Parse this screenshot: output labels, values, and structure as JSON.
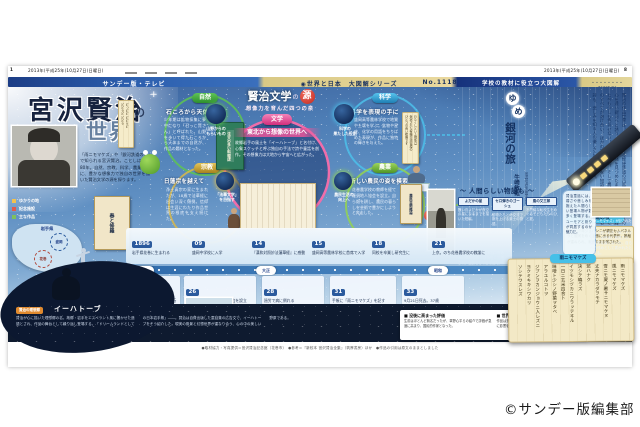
{
  "masthead": {
    "page_left": "1",
    "date_left": "2013年(平成25年)10月27日(日曜日)",
    "date_right": "2013年(平成25年)10月27日(日曜日)",
    "page_right": "8"
  },
  "bars": {
    "left": "サンデー版・テレビ",
    "center": "◉世界と日本　大図解シリーズ",
    "number": "No.1118",
    "right": "学校の教材に役立つ大図解",
    "sunday": "・・・・・・・・SUNDAY"
  },
  "title_block": {
    "main": "宮沢賢治",
    "no": "の",
    "world": "世界",
    "intro": "「雨ニモマケズ」や「銀河鉄道の夜」で知られる宮沢賢治。ことしは没後80年。自然、宗教、科学、農業を糧に、豊かな想像力で独自の世界を描いた賢治文学の源を探ります。"
  },
  "diagram": {
    "title_main": "賢治文学",
    "title_no": "の",
    "title_accent": "源",
    "subtitle": "想像力を育んだ四つの泉",
    "center": {
      "badge": "文学",
      "heading": "東北から想像の世界へ",
      "body": "故郷岩手の風土を「イーハトーブ」と名付け、心象スケッチと呼ぶ独自の手法で詩や童話を創作。その想像力は大地から宇宙へと広がった。"
    },
    "nature": {
      "badge": "自然",
      "heading": "石ころから天体まで",
      "body": "少年期は鉱物採集に夢中になり「石っこ賢さん」と呼ばれた。山野を歩いて得た石ころから天体までの自然が、作品の題材となった。"
    },
    "religion": {
      "badge": "宗教",
      "heading": "日蓮宗を越えて",
      "body": "浄土真宗の家に生まれたが、18歳で法華経に出会い深く傾倒。信仰は生涯にわたり作品世界の根底を支え続けた。"
    },
    "science": {
      "badge": "科学",
      "heading": "科学を表現の手に",
      "body": "盛岡高等農林学校で地質や土壌を学ぶ。鉱物や星座、化学の用語をちりばめた表現が、作品に独特の輝きを与えた。"
    },
    "farming": {
      "badge": "農業",
      "heading": "新しい農民の姿を模索",
      "body": "花巻農学校の教師を経て羅須地人協会を設立。自ら畑を耕し、農民の暮らしを芸術で豊かにしようと奔走した。"
    },
    "node_tl": "山野からの\nもらいもの",
    "node_bl": "「法華文学」\nを目指す",
    "node_tr": "科学の\n果たした役割",
    "node_br": "農民生活の\n向上へ",
    "slip1": "どっどど どどうど\nどどうど どどう",
    "slip2": "わたくしといふ現象は\n仮定された有機交流電燈の\nひとつの青い照明です",
    "book_green": "注文の多い料理店",
    "book_cream": "農民芸術概論"
  },
  "article": {
    "deco1": "ゆ",
    "deco2": "め",
    "title": "銀河の旅",
    "role": "宮沢賢治記念館学芸員",
    "author": "牛崎敏哉",
    "body": "賢治の作品世界は、夜空をわたる軽便鉄道の汽笛のように、読む人の心を遠い銀河へと誘う。郷土の自然を見つめたまなざしは、百年を経た今も少しも色あせない。科学と信仰、そして農民としての実践。そのすべてが溶け合い、ほかの誰にも書けない物語が生まれた。童話も詩も、悲しみを知る人の優しさに満ちている。"
  },
  "train": {
    "label": "銀河鉄道の夜",
    "caption": "貧しい少年ジョバンニが親友カムパネルラと銀河をめぐる旅に出る代表作。推敲が重ねられ、未完のまま残された。"
  },
  "stories": {
    "heading": "人間らしい物語も",
    "works": [
      {
        "t": "よだかの星",
        "d": "醜い鳥よだかが夜空の星になるまでを描いた短編。"
      },
      {
        "t": "セロ弾きのゴーシュ",
        "d": "動物たちとの交流で腕を上げる楽士の物語。"
      },
      {
        "t": "風の又三郎",
        "d": "不思議な転校生をめぐる子どもたちのひと夏。"
      }
    ],
    "box": "賢治童話には、弱さや悲しみを抱えた人間らしい登場人物が数多く登場する。ユーモアと祈りが同居するのが魅力だ。",
    "extra": "生前に刊行された本は2冊のみ。草稿の多くは没後に整理され、全集として世に出た。",
    "right_para": "手帳に記された「雨ニモマケズ」は死後に発見され、国民的な詩となった。自らへの戒めとして書かれたとされる。",
    "notebook_caption": "「雨ニモマケズ」が記された手帳"
  },
  "poem": {
    "label": "雨ニモマケズ",
    "text": "雨ニモマケズ\n風ニモマケズ\n雪ニモ夏ノ暑サニモマケヌ\n丈夫ナカラダヲモチ\n慾ハナク\n決シテ瞋ラズ\nイツモシヅカニワラッテヰル\n一日ニ玄米四合ト\n味噌ト少シノ野菜ヲタベ\nアラユルコトヲ\nジブンヲカンジョウニ入レズニ\nヨクミキキシワカリ\nソシテワスレズ"
  },
  "timeline": {
    "row1": [
      {
        "y": "1896",
        "t": "岩手県花巻に生まれる"
      },
      {
        "y": "09",
        "t": "盛岡中学校に入学"
      },
      {
        "y": "14",
        "t": "『漢和対照妙法蓮華経』に感動"
      },
      {
        "y": "15",
        "t": "盛岡高等農林学校に首席で入学"
      },
      {
        "y": "18",
        "t": "同校を卒業し研究生に"
      },
      {
        "y": "21",
        "t": "上京。のち花巻農学校の教諭に"
      }
    ],
    "eras": [
      "明治",
      "大正",
      "昭和"
    ],
    "row2": [
      {
        "y": "24",
        "t": "『春と修羅』『注文の多い料理店』を刊行"
      },
      {
        "y": "26",
        "t": "農学校を退職し羅須地人協会を設立"
      },
      {
        "y": "28",
        "t": "過労で病に倒れる"
      },
      {
        "y": "31",
        "t": "手帳に「雨ニモマケズ」を記す"
      },
      {
        "y": "33",
        "t": "9月21日死去。37歳"
      }
    ],
    "tag1": "心象スケッチ『春と修羅』",
    "tag2": "童話集『注文の多い料理店』",
    "photo_caption": "羅須地人協会の建物（花巻市）"
  },
  "left_panel": {
    "legend": [
      {
        "t": "ゆかりの地"
      },
      {
        "t": "記念施設"
      },
      {
        "t": "主な作品"
      }
    ],
    "map_label": "岩手県",
    "city1": "盛岡",
    "city2": "花巻",
    "book": "春と修羅"
  },
  "ihatov": {
    "tag": "賢治の理想郷",
    "title": "イーハトーブ",
    "body": "賢治が心に描いた理想郷の名。故郷・岩手をエスペラント風に響かせた造語とされ、作品の舞台として繰り返し登場する。「ドリームランドとしての日本岩手県」――。賢治は自費出版した童話集の広告文で、イーハトーブをそう紹介した。現実の風景と幻想世界が重なり合う、心の中の美しい野原である。"
  },
  "sidebar_box": {
    "h1": "■ 没後に高まった評価",
    "b1": "生前はほとんど無名だったが、草野心平らの紹介で評価が急速に高まり、国民的作家となった。",
    "h2": "■ 世界で読まれる賢治",
    "b2": "作品は多くの言語に翻訳され、アニメや音楽など幅広い分野に影響を与え続けている。"
  },
  "footer": "●取材協力・写真提供＝宮沢賢治記念館（花巻市）　●参考＝『新校本 宮沢賢治全集』（筑摩書房）ほか　●作品の引用は原文のままとしました",
  "credit": "©サンデー版編集部"
}
